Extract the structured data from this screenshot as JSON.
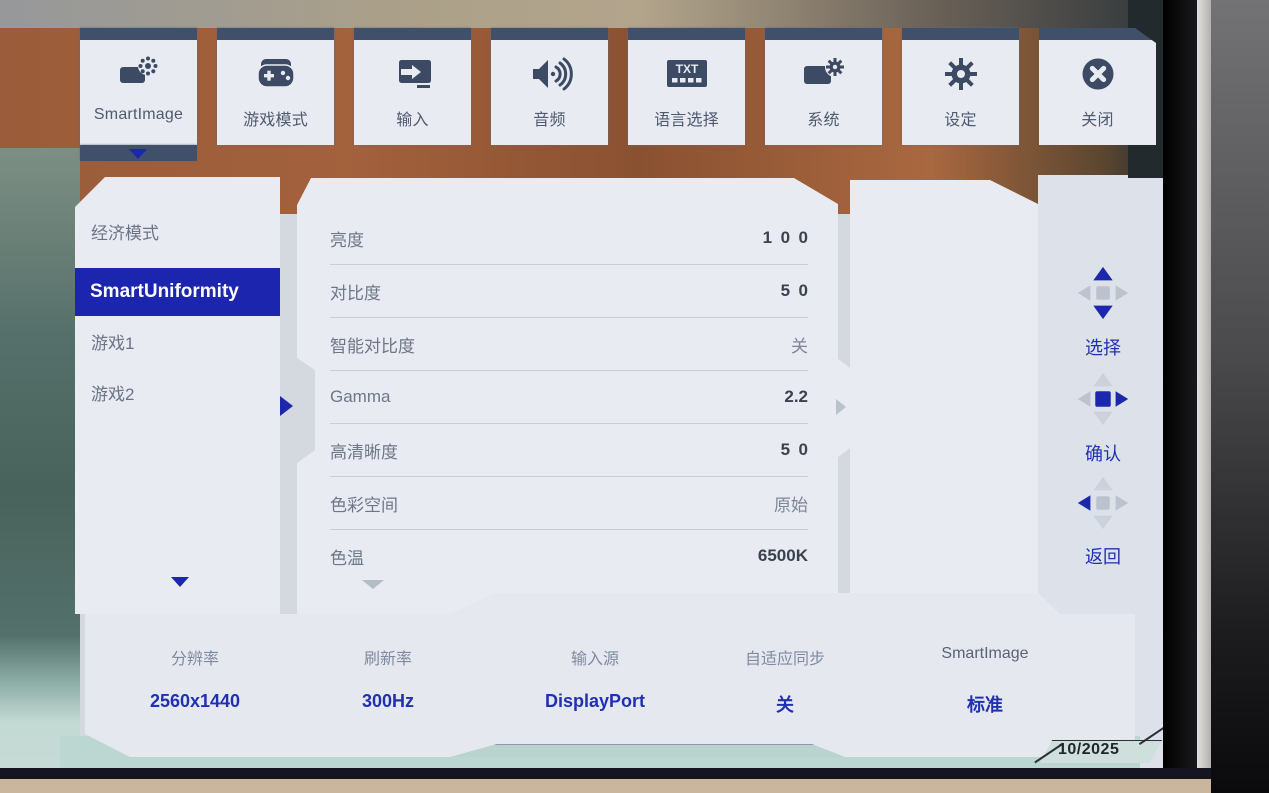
{
  "osd": {
    "tabs": [
      {
        "label": "SmartImage",
        "icon": "smartimage-icon",
        "selected": true
      },
      {
        "label": "游戏模式",
        "icon": "gamepad-icon",
        "selected": false
      },
      {
        "label": "输入",
        "icon": "input-arrow-icon",
        "selected": false
      },
      {
        "label": "音频",
        "icon": "speaker-icon",
        "selected": false
      },
      {
        "label": "语言选择",
        "icon": "txt-language-icon",
        "selected": false
      },
      {
        "label": "系统",
        "icon": "system-gear-icon",
        "selected": false
      },
      {
        "label": "设定",
        "icon": "gear-icon",
        "selected": false
      },
      {
        "label": "关闭",
        "icon": "close-x-icon",
        "selected": false
      }
    ],
    "sidebar": {
      "items": [
        {
          "label": "经济模式",
          "selected": false
        },
        {
          "label": "SmartUniformity",
          "selected": true
        },
        {
          "label": "游戏1",
          "selected": false
        },
        {
          "label": "游戏2",
          "selected": false
        }
      ]
    },
    "settings": {
      "rows": [
        {
          "label": "亮度",
          "value": "100"
        },
        {
          "label": "对比度",
          "value": "50"
        },
        {
          "label": "智能对比度",
          "value": "关"
        },
        {
          "label": "Gamma",
          "value": "2.2"
        },
        {
          "label": "高清晰度",
          "value": "50"
        },
        {
          "label": "色彩空间",
          "value": "原始"
        },
        {
          "label": "色温",
          "value": "6500K"
        }
      ]
    },
    "controls": [
      {
        "label": "选择",
        "icon": "dpad-up-down-icon"
      },
      {
        "label": "确认",
        "icon": "dpad-ok-right-icon"
      },
      {
        "label": "返回",
        "icon": "dpad-left-icon"
      }
    ],
    "status": {
      "items": [
        {
          "label": "分辨率",
          "value": "2560x1440"
        },
        {
          "label": "刷新率",
          "value": "300Hz"
        },
        {
          "label": "输入源",
          "value": "DisplayPort"
        },
        {
          "label": "自适应同步",
          "value": "关"
        },
        {
          "label": "SmartImage",
          "value": "标准"
        }
      ]
    },
    "colors": {
      "accent_blue": "#1c27ae",
      "panel": "#e8ebf1",
      "tab_strip_navy": "#40506a",
      "icon_ink": "#3d4a63",
      "status_value_blue": "#2030b2"
    }
  },
  "watermark": "10/2025"
}
